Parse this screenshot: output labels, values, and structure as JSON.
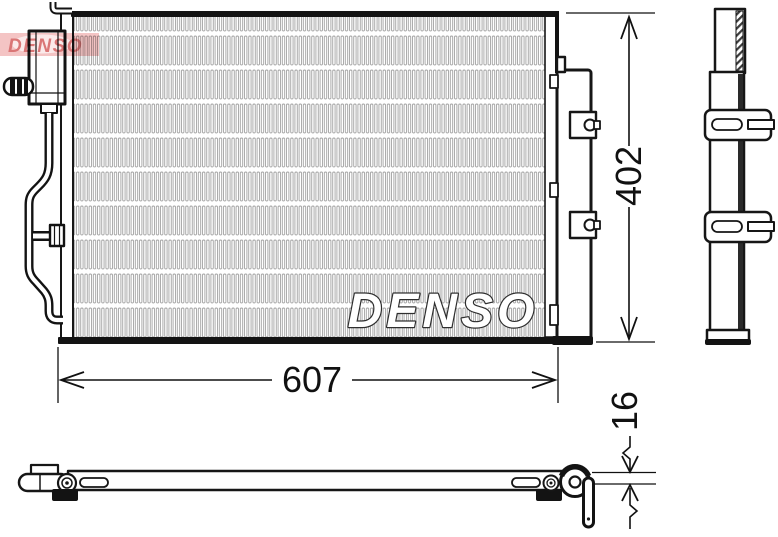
{
  "drawing": {
    "type": "technical-drawing-condenser",
    "brand_watermark_small": "DENSO",
    "brand_watermark_large": "DENSO",
    "dim_width": "607",
    "dim_height": "402",
    "dim_thickness": "16"
  },
  "colors": {
    "line": "#161616",
    "logo_band_bg": "#f3bfbf",
    "logo_band_highlight": "#fbe9e9",
    "logo_text_red": "#d76a6a",
    "fin_stroke": "#a2a2a2",
    "watermark_fill": "#ffffff",
    "watermark_outline": "#2e2e2e"
  }
}
